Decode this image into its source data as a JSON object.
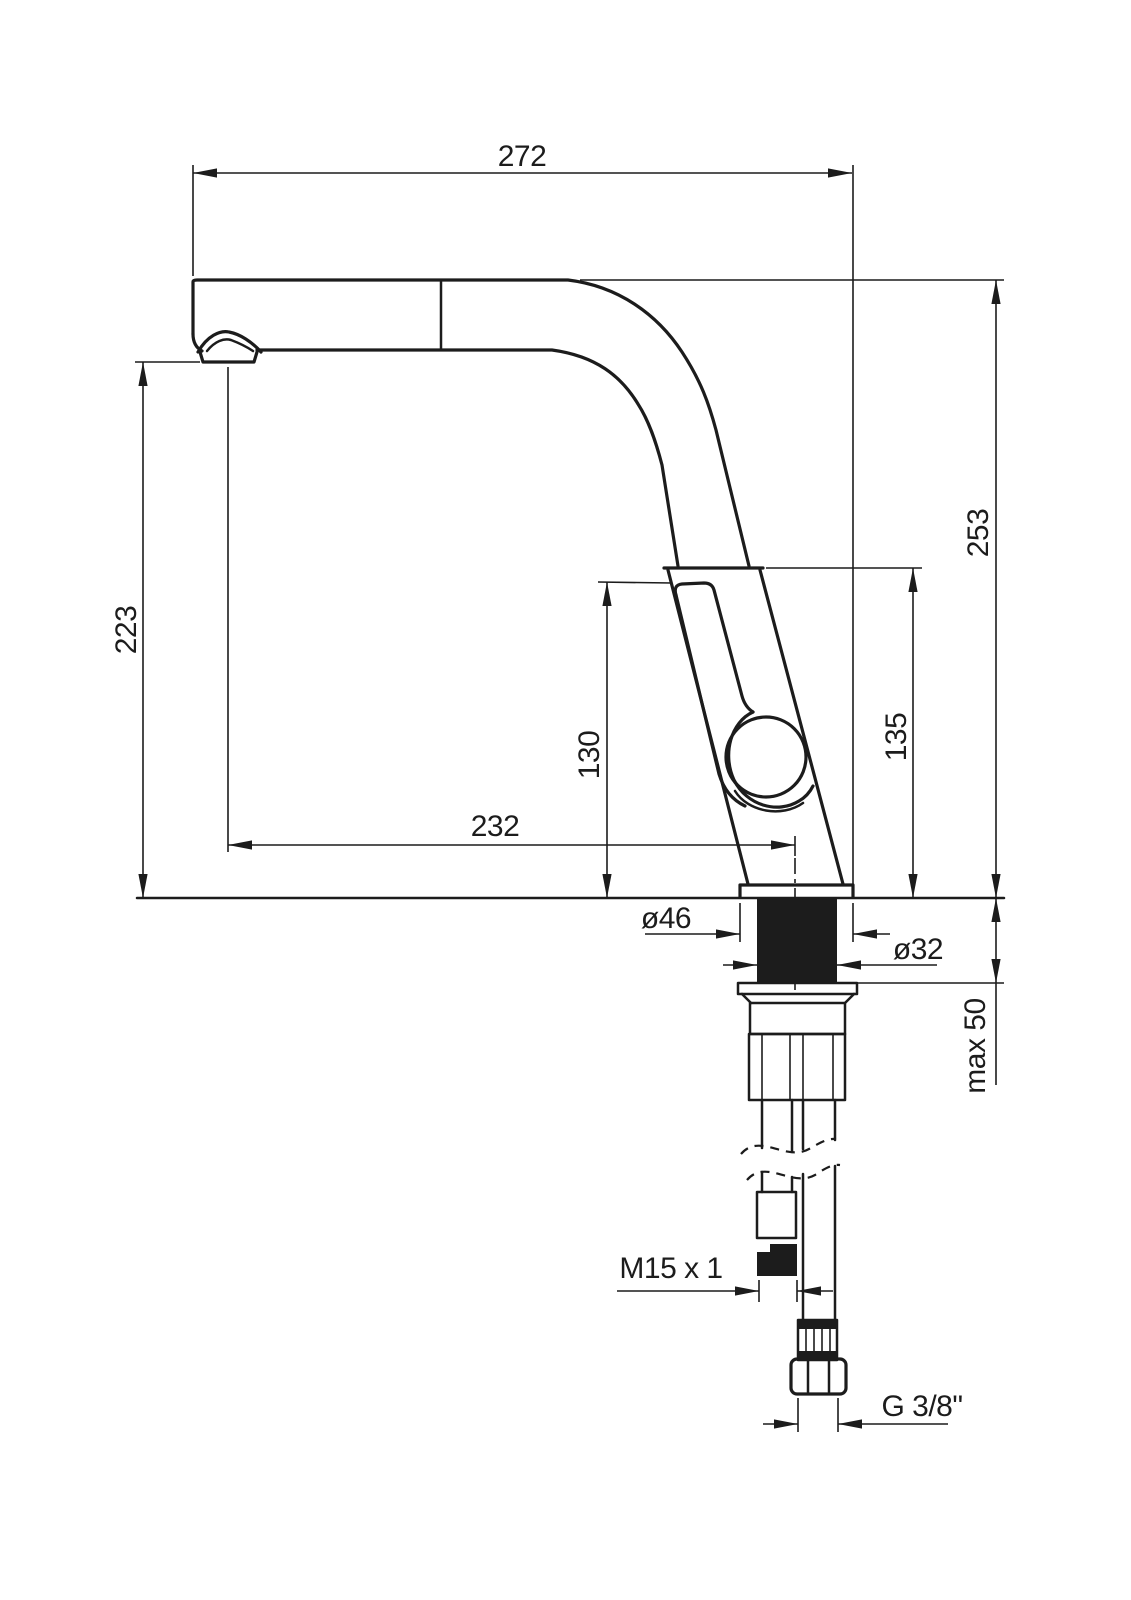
{
  "page": {
    "background": "#ffffff",
    "line_color": "#1c1c1c"
  },
  "drawing": {
    "type": "technical-drawing",
    "subject": "Kitchen pull-out faucet, side view with installation dimensions",
    "labels": {
      "width_overall": "272",
      "height_overall": "253",
      "height_to_spout": "223",
      "spout_reach": "232",
      "handle_height": "135",
      "lever_height": "130",
      "flange_diameter": "ø46",
      "shank_diameter": "ø32",
      "mounting_max": "max 50",
      "hose_thread": "M15 x 1",
      "supply_thread": "G 3/8\""
    }
  }
}
